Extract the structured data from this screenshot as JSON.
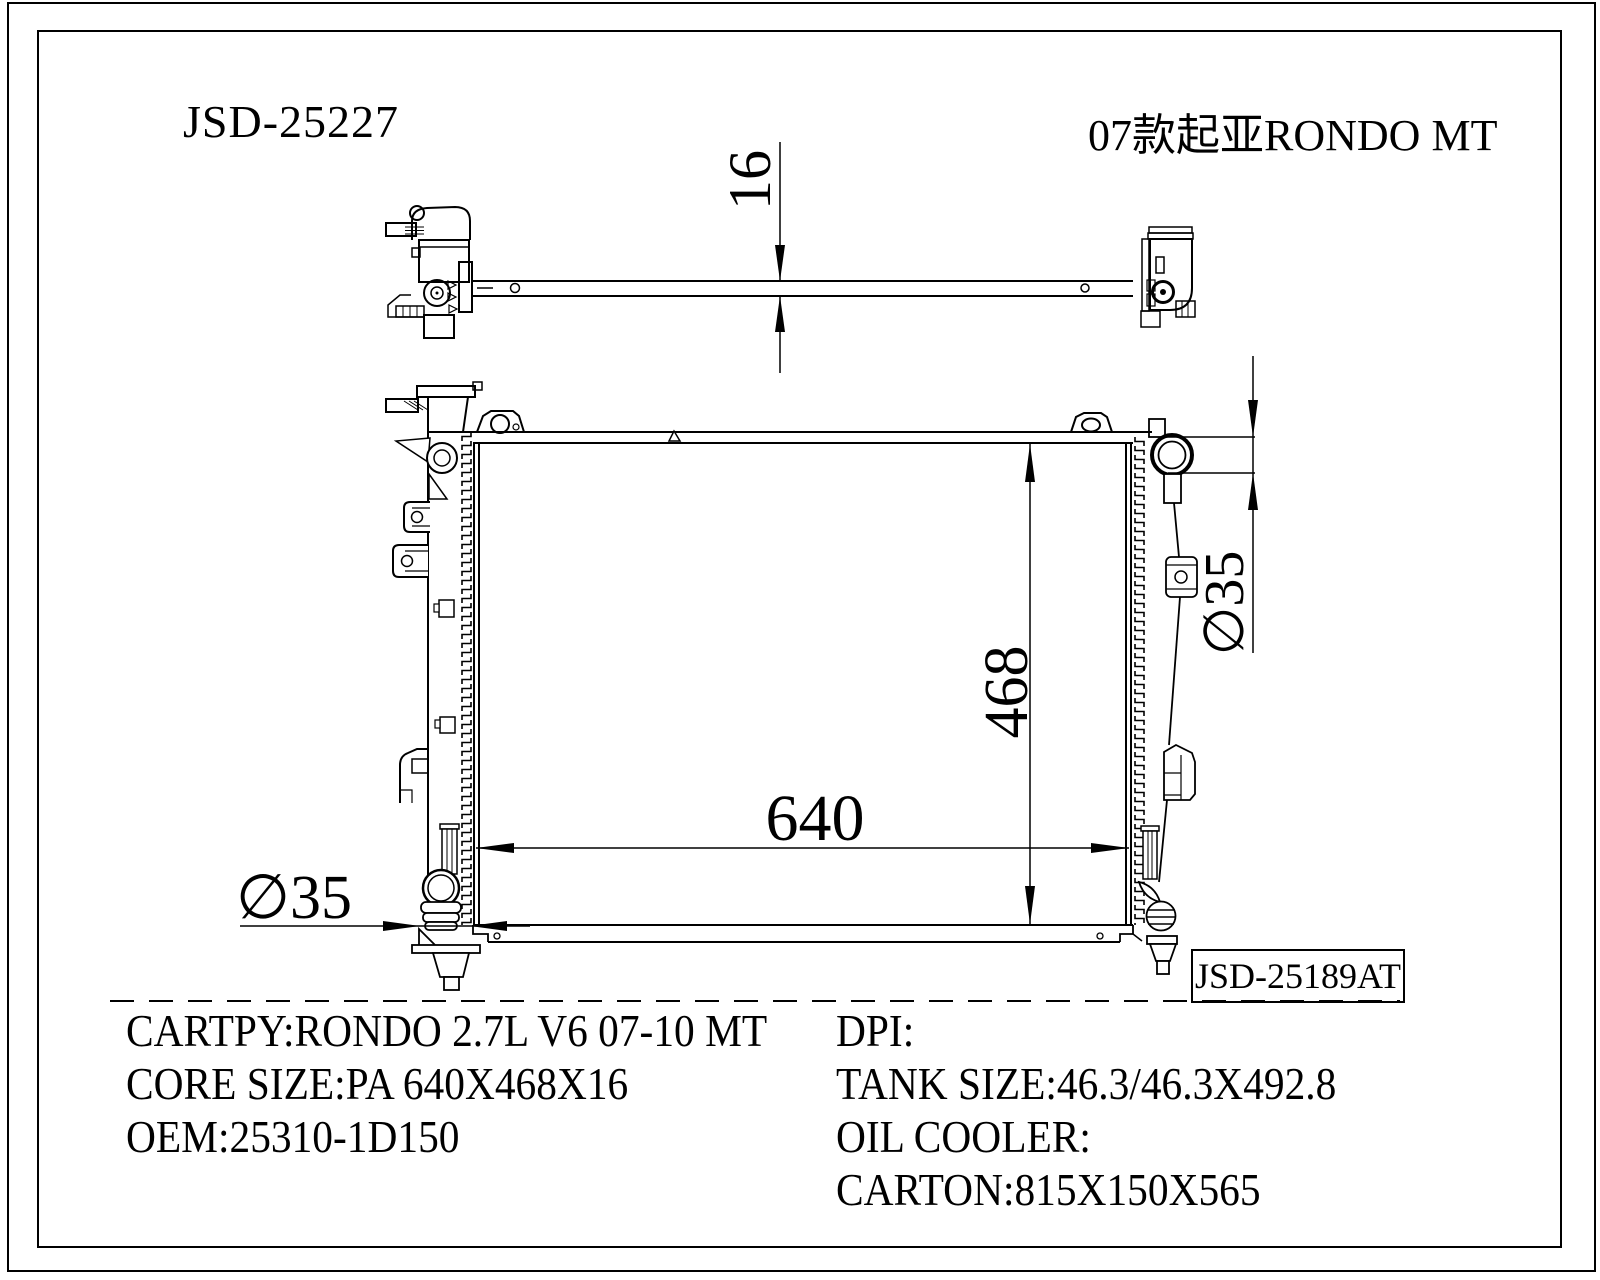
{
  "colors": {
    "line": "#000000",
    "background": "#ffffff"
  },
  "header": {
    "part_number": "JSD-25227",
    "model_title": "07款起亚RONDO MT"
  },
  "drawing": {
    "dimensions": {
      "core_thickness": "16",
      "core_height": "468",
      "core_width": "640",
      "inlet_diameter": "∅35",
      "outlet_diameter": "∅35"
    },
    "ref_label": "JSD-25189AT"
  },
  "specs": {
    "left": [
      "CARTPY:RONDO 2.7L V6 07-10 MT",
      "CORE SIZE:PA 640X468X16",
      "OEM:25310-1D150"
    ],
    "right": [
      "DPI:",
      "TANK SIZE:46.3/46.3X492.8",
      "OIL COOLER:",
      "CARTON:815X150X565"
    ]
  }
}
